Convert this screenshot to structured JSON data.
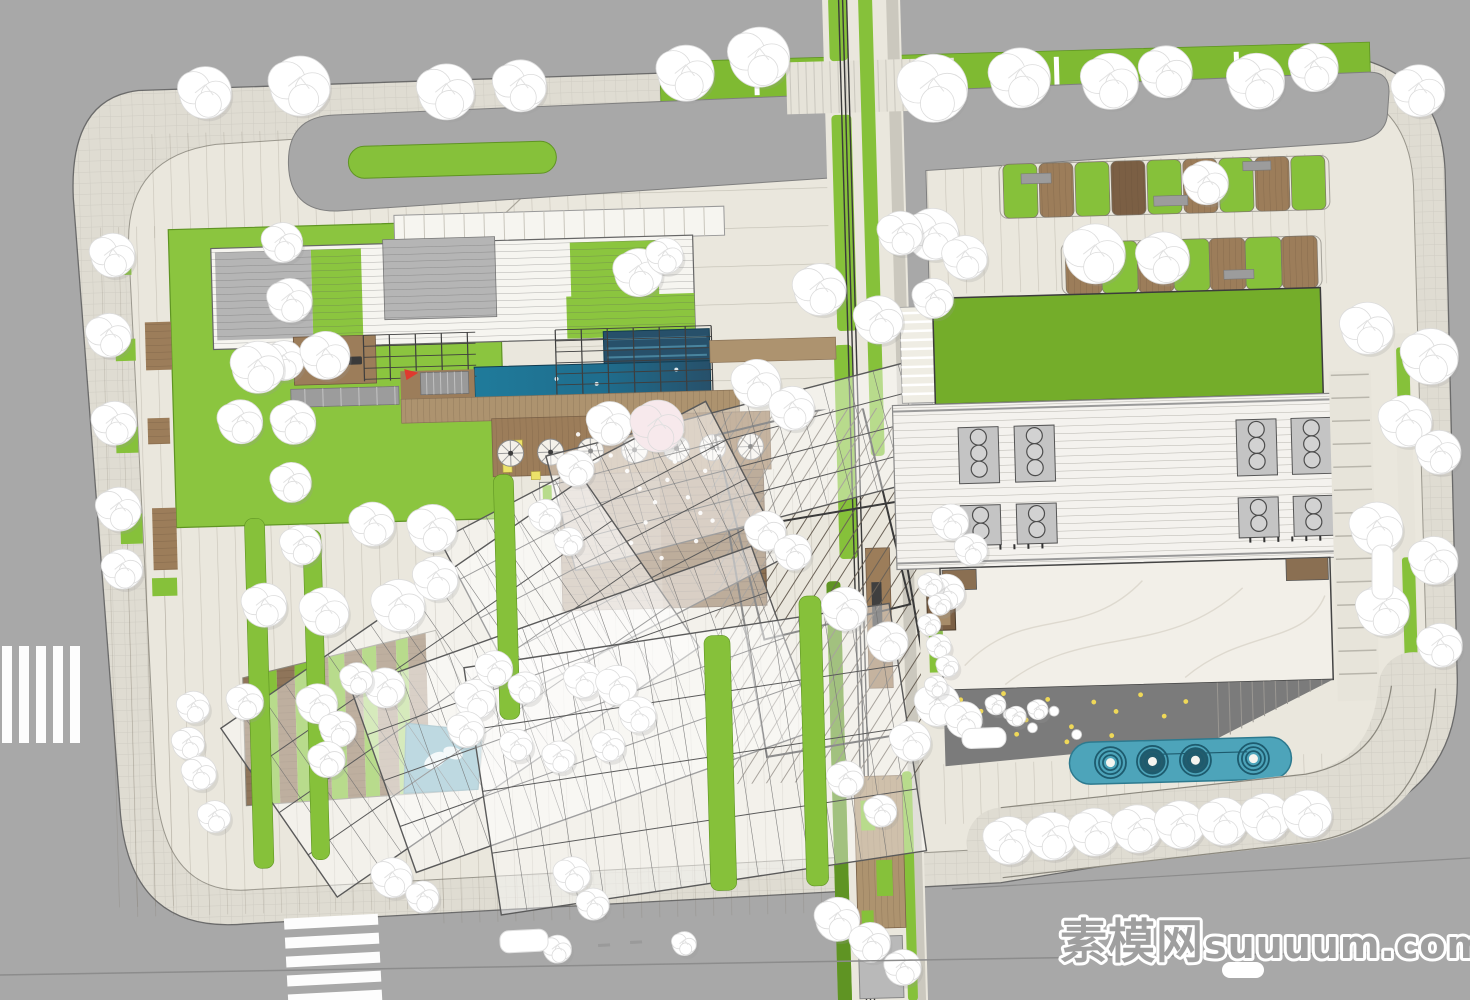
{
  "title": "Residential landscape master plan - top view site rendering",
  "watermark": {
    "cn": "素模网",
    "en": "suuuum.com"
  },
  "palette": {
    "road": "#a8a8a8",
    "roadLine": "#8c8c8c",
    "sidewalk": "#dfdcd2",
    "paving": "#eae7dd",
    "pavingLine": "#b5b1a4",
    "curb": "#8f8c84",
    "gridLine": "rgba(0,0,0,0.07)",
    "lawn": "#8bc53f",
    "lawnDark": "#74ad2a",
    "hedge": "#7fba32",
    "greenStrip": "#86c13a",
    "greenDark": "#5f9423",
    "wood": "#9c7d5a",
    "woodDark": "#7b5f44",
    "woodLight": "#ad936f",
    "plankLine": "#6e5640",
    "poolBright": "#1f7b9b",
    "poolDark": "#27506a",
    "poolLane": "#49849e",
    "poolEdge": "#123c50",
    "smallPool": "#4090a8",
    "waterFeature": "#4da4ba",
    "waterRing": "#1d5b6e",
    "roofWhite": "#f6f5f0",
    "roofGray": "#b5b5b5",
    "louverLine": "#7e7e7e",
    "frame": "#4a4a4a",
    "canopyStroke": "#5a5a5a",
    "slat": "#6b6257",
    "marble": "#f2efe8",
    "vein": "#d8d3c8",
    "plazaDark": "#7b7b7b",
    "dotYellow": "#efd858",
    "stone": "#9c9c9c",
    "treeFill": "#ffffff",
    "treeEdge": "#dcdcdc",
    "treeShadow": "#9a9a9a",
    "blossom": "#f7e9ec",
    "accentRed": "#e0392e",
    "accentYellow": "#ece269",
    "white": "#ffffff",
    "watermark": "#9f9f9f"
  },
  "site": {
    "rotation": -1.6,
    "cx": 735,
    "cy": 500,
    "outline": "M 150,74 L 1300,68 Q 1452,66 1454,190 L 1452,700 Q 1450,812 1330,844 L 990,890 L 235,910 Q 120,918 112,798 L 82,180 Q 80,80 150,74 Z",
    "inner": "M 650,114 L 1302,100 Q 1420,98 1422,205 L 1422,690 Q 1420,786 1314,813 L 983,856 L 242,876 Q 152,882 148,766 L 136,232 Q 134,140 226,130 Z",
    "ringRoad": "M 346,104 L 1380,90 Q 1402,90 1400,112 L 1398,132 Q 1396,158 1356,160 L 935,176 L 935,430 L 910,431 L 910,178 L 346,200 Q 298,200 298,152 Q 298,104 346,104 Z",
    "median": [
      358,
      136,
      208,
      32
    ],
    "hedge": [
      672,
      60,
      710,
      42
    ],
    "hedgeTicks": [
      706,
      766,
      826,
      946,
      1006,
      1066,
      1126,
      1186,
      1246,
      1306
    ],
    "diagonalPath": [
      238,
      455,
      560,
      165
    ]
  },
  "pavingRegions": {
    "vstripe": [
      [
        150,
        118,
        510,
        104
      ],
      [
        100,
        210,
        80,
        680
      ],
      [
        110,
        500,
        330,
        400
      ],
      [
        420,
        470,
        425,
        445
      ],
      [
        935,
        170,
        410,
        130
      ],
      [
        935,
        770,
        395,
        60
      ]
    ],
    "hband": [
      [
        560,
        160,
        285,
        258
      ]
    ]
  },
  "greenway": {
    "base": [
      836,
      0,
      78,
      1010
    ],
    "grayStrip": [
      900,
      0,
      12,
      1010
    ],
    "greens": [
      [
        842,
        0,
        18,
        64
      ],
      [
        842,
        118,
        20,
        216
      ],
      [
        872,
        0,
        14,
        460
      ],
      [
        838,
        348,
        18,
        214
      ],
      [
        824,
        584,
        14,
        426
      ],
      [
        894,
        776,
        10,
        230
      ]
    ],
    "rails": [
      852.5,
      856.5,
      860.5
    ],
    "crosswalkBand": [
      798,
      64,
      168,
      52
    ],
    "midDeck": [
      864,
      552,
      24,
      140
    ],
    "bench": [
      869,
      586,
      10,
      52
    ],
    "lowerDeck": [
      846,
      780,
      48,
      152
    ],
    "deckGreens": [
      [
        852,
        804,
        14,
        30
      ],
      [
        866,
        864,
        16,
        36
      ],
      [
        850,
        914,
        12,
        26
      ]
    ],
    "pad": [
      846,
      940,
      44,
      62
    ]
  },
  "fingers": {
    "row1": {
      "y": 172,
      "h": 54,
      "w": 34,
      "cells": [
        [
          1012,
          "g"
        ],
        [
          1048,
          "w"
        ],
        [
          1084,
          "g"
        ],
        [
          1120,
          "d"
        ],
        [
          1156,
          "g"
        ],
        [
          1192,
          "w"
        ],
        [
          1228,
          "g"
        ],
        [
          1264,
          "w"
        ],
        [
          1300,
          "g"
        ]
      ],
      "frame": [
        1008,
        172,
        330,
        54
      ]
    },
    "row2": {
      "y": 252,
      "h": 52,
      "w": 36,
      "cells": [
        [
          1072,
          "w"
        ],
        [
          1108,
          "g"
        ],
        [
          1144,
          "w"
        ],
        [
          1180,
          "g"
        ],
        [
          1216,
          "w"
        ],
        [
          1252,
          "g"
        ],
        [
          1288,
          "w"
        ]
      ],
      "frame": [
        1068,
        252,
        260,
        52
      ]
    },
    "slabs": [
      [
        1030,
        182,
        30,
        10
      ],
      [
        1162,
        208,
        34,
        10
      ],
      [
        1252,
        176,
        28,
        9
      ],
      [
        1090,
        276,
        30,
        9
      ],
      [
        1230,
        284,
        30,
        9
      ]
    ]
  },
  "leftBuilding": {
    "lawn": [
      176,
      214,
      330,
      298
    ],
    "topBand": [
      402,
      206,
      330,
      29
    ],
    "roof": [
      218,
      234,
      482,
      101
    ],
    "grayPanel1": [
      222,
      238,
      96,
      88
    ],
    "greenPanel1": [
      318,
      238,
      50,
      88
    ],
    "grayPanel2": [
      390,
      230,
      112,
      80
    ],
    "greenPanel2": [
      577,
      238,
      88,
      94
    ],
    "greenUnder": [
      572,
      292,
      128,
      42
    ],
    "loungeDeck": [
      298,
      325,
      82,
      48
    ],
    "sofas": [
      [
        308,
        346,
        14,
        8
      ],
      [
        352,
        346,
        14,
        8
      ]
    ],
    "firepit": [
      333,
      350,
      4.5
    ],
    "chairs": [
      [
        316,
        334
      ],
      [
        345,
        334
      ],
      [
        326,
        360
      ],
      [
        340,
        360
      ]
    ],
    "stoneBand": [
      294,
      377,
      108,
      18
    ],
    "trellisA": [
      368,
      325,
      112,
      46
    ],
    "trellisB": [
      560,
      325,
      156,
      66
    ],
    "poolUpper": [
      608,
      328,
      106,
      34
    ],
    "poolMain": [
      478,
      360,
      236,
      32
    ],
    "woodStrip": [
      404,
      362,
      74,
      30
    ],
    "steps": [
      424,
      364,
      48,
      22
    ],
    "redMark": [
      408,
      360
    ],
    "woodBand": [
      404,
      390,
      338,
      24
    ],
    "woodWalk": [
      714,
      340,
      126,
      22
    ],
    "umbrellaDeck": [
      494,
      412,
      278,
      58
    ],
    "umbrellaY": 447,
    "umbrellaXs": [
      512,
      552,
      592,
      636,
      678,
      714,
      752
    ],
    "yellowSeats": [
      [
        514,
        434,
        10,
        9
      ],
      [
        504,
        458,
        9,
        8
      ],
      [
        532,
        466,
        9,
        8
      ]
    ],
    "planters": [
      [
        540,
        477
      ],
      [
        568,
        477
      ]
    ],
    "deckSteps": [
      560,
      470,
      204,
      136
    ]
  },
  "wedge": {
    "clip": "238,664 432,622 478,724 470,782 238,792",
    "stripWidths": [
      20,
      14,
      18,
      12,
      22,
      16,
      18,
      14,
      20,
      12,
      18
    ],
    "pool": "400,714 476,724 470,782 396,784",
    "dolphins": [
      [
        428,
        752,
        12,
        7,
        -30
      ],
      [
        446,
        745,
        10,
        6,
        20
      ]
    ]
  },
  "canopies": [
    [
      770,
      460,
      430,
      118,
      -13
    ],
    [
      612,
      545,
      300,
      175,
      -26
    ],
    [
      455,
      680,
      440,
      205,
      -33
    ],
    [
      578,
      705,
      425,
      195,
      -18
    ],
    [
      688,
      758,
      430,
      250,
      -7
    ]
  ],
  "slatField": {
    "clip": [
      712,
      412,
      204,
      372
    ],
    "angle": 34,
    "cx": 814,
    "cy": 598,
    "spacing": 12,
    "heavy": [
      [
        737,
        417,
        150,
        210,
        -12
      ],
      [
        743,
        517,
        170,
        230,
        -8
      ]
    ]
  },
  "greenStrips": [
    [
      244,
      505,
      20,
      350
    ],
    [
      302,
      518,
      18,
      330
    ],
    [
      494,
      468,
      20,
      245
    ],
    [
      700,
      635,
      26,
      255
    ],
    [
      796,
      598,
      22,
      290
    ]
  ],
  "leftStreet": {
    "woods": [
      [
        150,
        306,
        26,
        48
      ],
      [
        150,
        402,
        22,
        26
      ],
      [
        152,
        492,
        24,
        62
      ]
    ],
    "greens": [
      [
        118,
        230,
        20,
        28
      ],
      [
        120,
        322,
        20,
        22
      ],
      [
        118,
        410,
        22,
        26
      ],
      [
        120,
        497,
        22,
        30
      ],
      [
        150,
        562,
        25,
        18
      ]
    ]
  },
  "rightBuilding": {
    "stepStrip": [
      905,
      312,
      33,
      96
    ],
    "lawn": [
      938,
      304,
      388,
      106
    ],
    "roof": [
      895,
      410,
      456,
      164
    ],
    "ventCols": [
      962,
      1018,
      1240,
      1295
    ],
    "ventTopY": 436,
    "ventBottomY": 514,
    "tickY": 552,
    "tickXs1": 970,
    "tickXs2": 1248,
    "marble": [
      938,
      574,
      390,
      122
    ],
    "cornerWoods": [
      [
        940,
        576,
        34,
        20
      ],
      [
        1284,
        574,
        42,
        22
      ]
    ],
    "plaza": "938,696 1328,696 1206,754 938,772",
    "plazaDots": [
      [
        955,
        706
      ],
      [
        975,
        718
      ],
      [
        998,
        701
      ],
      [
        1020,
        728
      ],
      [
        1042,
        708
      ],
      [
        1065,
        736
      ],
      [
        1088,
        712
      ],
      [
        1110,
        722
      ],
      [
        1135,
        706
      ],
      [
        1158,
        728
      ],
      [
        1180,
        714
      ],
      [
        960,
        736
      ],
      [
        985,
        748
      ],
      [
        1010,
        742
      ],
      [
        1060,
        751
      ],
      [
        1105,
        746
      ]
    ],
    "tables": [
      [
        1002,
        722
      ],
      [
        1026,
        736
      ],
      [
        1048,
        720
      ],
      [
        1070,
        744
      ]
    ],
    "stepFan": [
      1212,
      696,
      10,
      11.6,
      5.8
    ],
    "gardenStrip": [
      925,
      582,
      14,
      96
    ],
    "hut": [
      924,
      600,
      28,
      36
    ]
  },
  "waterFeature": {
    "rect": [
      1062,
      752,
      222,
      42
    ],
    "ringXs": [
      1103,
      1145,
      1188,
      1246
    ],
    "cy": 773,
    "filled": [
      1145,
      1188
    ],
    "pipe": [
      1150,
      766,
      1240,
      766
    ]
  },
  "eastParking": {
    "base": [
      1332,
      388,
      42,
      330
    ],
    "stallYs": [
      392,
      415,
      438,
      461,
      484,
      507,
      530,
      553,
      576,
      599,
      622,
      645,
      668,
      691
    ],
    "walkStrip": [
      1398,
      352,
      16,
      356
    ],
    "hedges": [
      [
        1400,
        366,
        13,
        82
      ],
      [
        1400,
        576,
        13,
        118
      ]
    ]
  },
  "southPromenade": {
    "path": "M 992,850 L 1300,824 Q 1396,810 1408,706",
    "edgeTop": "M 992,815 L 1298,790 Q 1374,778 1386,704",
    "edgeBottom": "M 992,885 L 1302,858 Q 1418,842 1430,708",
    "tickXs": [
      1046,
      1090,
      1134,
      1178,
      1222,
      1266
    ]
  },
  "trees": [
    [
      217,
      78,
      26
    ],
    [
      312,
      74,
      30
    ],
    [
      458,
      84,
      28
    ],
    [
      532,
      80,
      26
    ],
    [
      698,
      72,
      28
    ],
    [
      772,
      58,
      30
    ],
    [
      945,
      94,
      34
    ],
    [
      1032,
      86,
      30
    ],
    [
      1122,
      92,
      28
    ],
    [
      1178,
      84,
      26
    ],
    [
      1268,
      96,
      28
    ],
    [
      1326,
      84,
      24
    ],
    [
      1430,
      110,
      26
    ],
    [
      940,
      240,
      26
    ],
    [
      972,
      264,
      22
    ],
    [
      1102,
      264,
      30
    ],
    [
      1170,
      270,
      26
    ],
    [
      1215,
      196,
      22
    ],
    [
      1372,
      346,
      26
    ],
    [
      1434,
      376,
      28
    ],
    [
      1408,
      440,
      26
    ],
    [
      1440,
      472,
      22
    ],
    [
      1376,
      546,
      26
    ],
    [
      1432,
      580,
      24
    ],
    [
      1380,
      628,
      26
    ],
    [
      1436,
      665,
      22
    ],
    [
      999,
      848,
      24
    ],
    [
      1042,
      845,
      24
    ],
    [
      1085,
      842,
      24
    ],
    [
      1128,
      840,
      24
    ],
    [
      1171,
      837,
      24
    ],
    [
      1214,
      835,
      24
    ],
    [
      1257,
      832,
      24
    ],
    [
      1299,
      830,
      24
    ],
    [
      120,
      238,
      22
    ],
    [
      114,
      318,
      22
    ],
    [
      117,
      406,
      22
    ],
    [
      119,
      492,
      22
    ],
    [
      121,
      552,
      20
    ],
    [
      290,
      230,
      20
    ],
    [
      296,
      288,
      22
    ],
    [
      288,
      348,
      20
    ],
    [
      296,
      410,
      22
    ],
    [
      292,
      470,
      20
    ],
    [
      300,
      533,
      20
    ],
    [
      262,
      354,
      26
    ],
    [
      330,
      344,
      24
    ],
    [
      243,
      408,
      22
    ],
    [
      372,
      514,
      22
    ],
    [
      432,
      520,
      24
    ],
    [
      262,
      592,
      22
    ],
    [
      322,
      600,
      24
    ],
    [
      396,
      596,
      26
    ],
    [
      434,
      570,
      22
    ],
    [
      545,
      510,
      16
    ],
    [
      568,
      537,
      14
    ],
    [
      645,
      270,
      24
    ],
    [
      672,
      254,
      18
    ],
    [
      577,
      464,
      18
    ],
    [
      612,
      420,
      22
    ],
    [
      760,
      384,
      24
    ],
    [
      795,
      410,
      22
    ],
    [
      826,
      292,
      26
    ],
    [
      884,
      324,
      24
    ],
    [
      908,
      238,
      22
    ],
    [
      939,
      304,
      20
    ],
    [
      765,
      532,
      20
    ],
    [
      792,
      554,
      18
    ],
    [
      842,
      612,
      22
    ],
    [
      884,
      646,
      20
    ],
    [
      932,
      710,
      22
    ],
    [
      904,
      746,
      20
    ],
    [
      958,
      726,
      18
    ],
    [
      950,
      528,
      18
    ],
    [
      970,
      556,
      16
    ],
    [
      944,
      598,
      18
    ],
    [
      838,
      782,
      18
    ],
    [
      872,
      815,
      16
    ],
    [
      240,
      688,
      18
    ],
    [
      188,
      692,
      16
    ],
    [
      182,
      728,
      16
    ],
    [
      192,
      758,
      17
    ],
    [
      206,
      802,
      16
    ],
    [
      312,
      692,
      20
    ],
    [
      332,
      718,
      18
    ],
    [
      320,
      748,
      18
    ],
    [
      380,
      678,
      20
    ],
    [
      352,
      668,
      16
    ],
    [
      470,
      692,
      20
    ],
    [
      460,
      722,
      18
    ],
    [
      490,
      662,
      18
    ],
    [
      520,
      682,
      16
    ],
    [
      578,
      676,
      18
    ],
    [
      612,
      682,
      20
    ],
    [
      632,
      712,
      18
    ],
    [
      602,
      742,
      16
    ],
    [
      552,
      752,
      16
    ],
    [
      510,
      739,
      16
    ],
    [
      382,
      868,
      20
    ],
    [
      412,
      888,
      16
    ],
    [
      562,
      870,
      18
    ],
    [
      582,
      900,
      16
    ],
    [
      545,
      944,
      14
    ],
    [
      826,
      922,
      22
    ],
    [
      858,
      946,
      20
    ],
    [
      890,
      972,
      18
    ],
    [
      672,
      942,
      12
    ],
    [
      928,
      590,
      12
    ],
    [
      937,
      610,
      11
    ],
    [
      926,
      630,
      11
    ],
    [
      935,
      652,
      12
    ],
    [
      943,
      672,
      11
    ],
    [
      931,
      692,
      11
    ],
    [
      990,
      712,
      10
    ],
    [
      1010,
      724,
      10
    ],
    [
      1032,
      718,
      10
    ]
  ],
  "blossoms": [
    [
      660,
      424,
      26
    ]
  ],
  "petals": [
    [
      612,
      452
    ],
    [
      628,
      468
    ],
    [
      640,
      486
    ],
    [
      655,
      500
    ],
    [
      668,
      478
    ],
    [
      676,
      460
    ],
    [
      688,
      496
    ],
    [
      700,
      512
    ],
    [
      645,
      520
    ],
    [
      630,
      540
    ],
    [
      660,
      556
    ],
    [
      695,
      540
    ],
    [
      712,
      520
    ],
    [
      580,
      430
    ],
    [
      596,
      444
    ],
    [
      706,
      470
    ],
    [
      720,
      452
    ],
    [
      684,
      430
    ]
  ],
  "poolSparkles": [
    [
      560,
      374
    ],
    [
      600,
      380
    ],
    [
      680,
      368
    ]
  ],
  "roadMarkings": {
    "leftZebra": {
      "xs": [
        2,
        19,
        36,
        53,
        70
      ],
      "y": 646,
      "w": 10,
      "h": 97
    },
    "bottomZebra": {
      "x": 286,
      "ys": [
        916,
        935,
        954,
        973,
        992
      ],
      "w": 94,
      "h": 11,
      "rotate": [
        -3,
        335,
        958
      ]
    },
    "laneLine": [
      0,
      975,
      1470,
      951
    ],
    "diagLine": [
      952,
      889,
      1470,
      858
    ],
    "dashes": [
      [
        598,
        944,
        12,
        3
      ],
      [
        630,
        941,
        12,
        3
      ]
    ],
    "cars": [
      [
        500,
        930,
        48,
        22,
        9,
        -3
      ],
      [
        962,
        728,
        44,
        20,
        9,
        -2
      ],
      [
        1372,
        545,
        21,
        54,
        9,
        0
      ]
    ],
    "blob": [
      1222,
      962,
      42,
      16,
      8
    ]
  }
}
